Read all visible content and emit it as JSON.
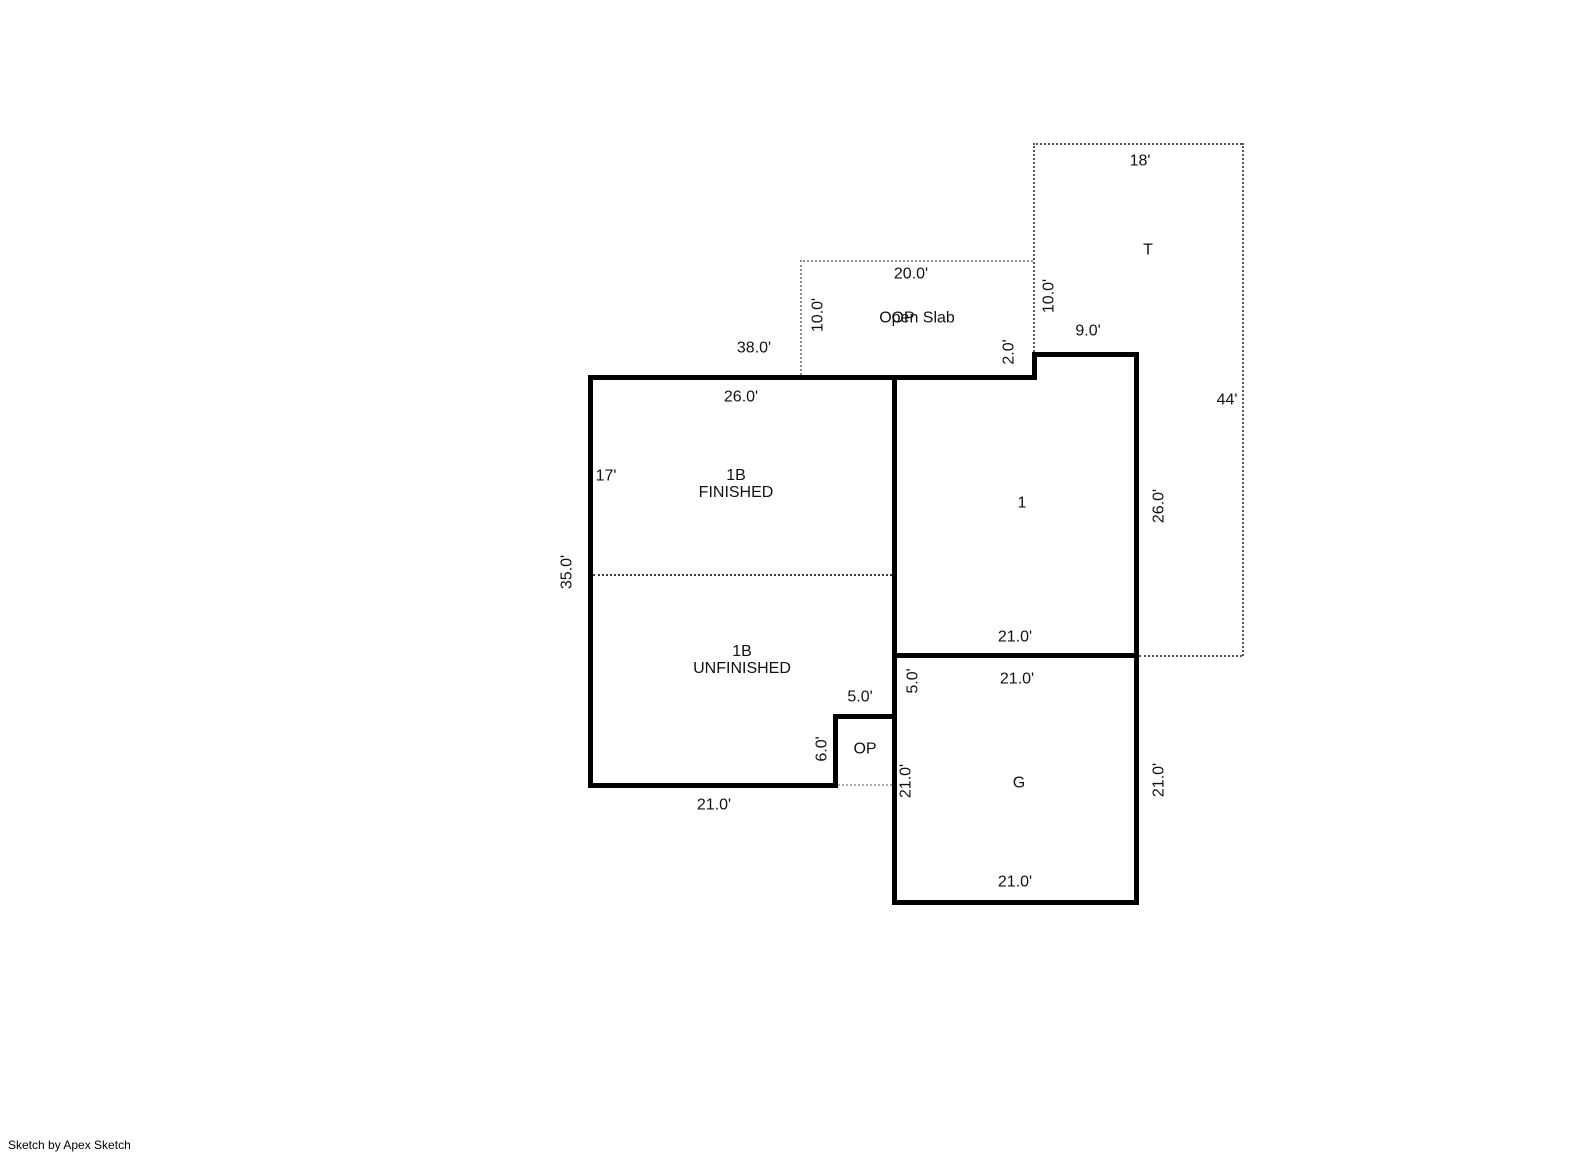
{
  "credit": "Sketch by Apex Sketch",
  "rooms": {
    "t": "T",
    "open_slab": "Open Slab",
    "open_slab_overlay": "OP",
    "b1f_line1": "1B",
    "b1f_line2": "FINISHED",
    "b1u_line1": "1B",
    "b1u_line2": "UNFINISHED",
    "one": "1",
    "garage": "G",
    "op": "OP"
  },
  "dims": {
    "t_top": "18'",
    "t_right": "44'",
    "slab_top": "20.0'",
    "slab_left": "10.0'",
    "slab_right": "10.0'",
    "step_right": "2.0'",
    "top_right": "9.0'",
    "main_top": "38.0'",
    "b1_top": "26.0'",
    "b1_left_upper": "17'",
    "b1_left": "35.0'",
    "b1_bottom": "21.0'",
    "op_top": "5.0'",
    "op_left": "6.0'",
    "one_bottom": "21.0'",
    "one_right": "26.0'",
    "g_top": "21.0'",
    "g_left_upper": "5.0'",
    "g_left": "21.0'",
    "g_right": "21.0'",
    "g_bottom": "21.0'"
  }
}
